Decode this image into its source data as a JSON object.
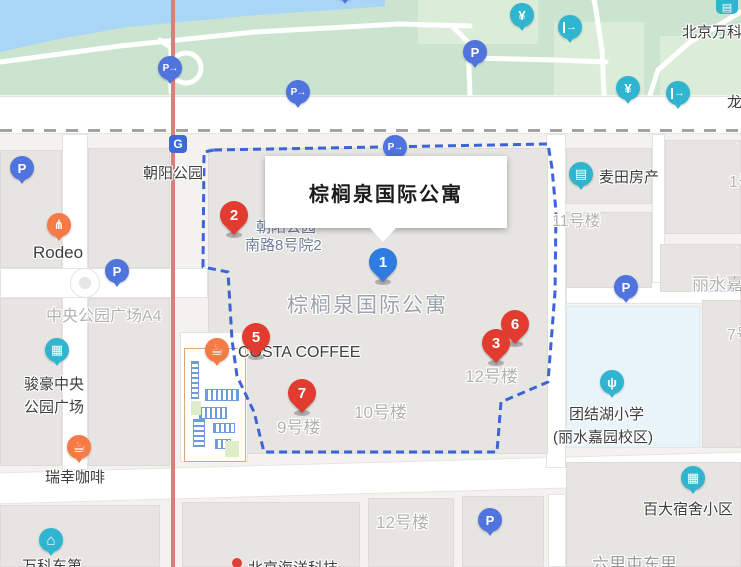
{
  "popup": {
    "title": "棕榈泉国际公寓"
  },
  "colors": {
    "boundary": "#3d63d9",
    "marker_red": "#e23b30",
    "marker_blue": "#2e7ce2",
    "poi_blue": "#4f74dd",
    "poi_teal": "#2fb5cf",
    "poi_orange": "#f57a45",
    "park_green": "#cbe4cf",
    "water": "#a9d6f6",
    "railway": "#d1827b"
  },
  "markers": [
    {
      "n": "2",
      "color": "red",
      "x": 234,
      "y": 215
    },
    {
      "n": "5",
      "color": "red",
      "x": 256,
      "y": 337
    },
    {
      "n": "7",
      "color": "red",
      "x": 302,
      "y": 393
    },
    {
      "n": "6",
      "color": "red",
      "x": 515,
      "y": 324
    },
    {
      "n": "3",
      "color": "red",
      "x": 496,
      "y": 343
    },
    {
      "n": "1",
      "color": "blue",
      "x": 383,
      "y": 262
    }
  ],
  "icon_types": {
    "parking": {
      "g": "P",
      "cls": "blue-poi"
    },
    "parking-arrow": {
      "g": "P→",
      "cls": "blue-poi"
    },
    "ticket": {
      "g": "¥",
      "cls": "teal-poi"
    },
    "exit": {
      "g": "→",
      "cls": "teal-poi"
    },
    "shop": {
      "g": "▤",
      "cls": "teal-poi"
    },
    "building": {
      "g": "▦",
      "cls": "teal-poi"
    },
    "house": {
      "g": "⌂",
      "cls": "teal-poi bigg"
    },
    "sprout": {
      "g": "ψ",
      "cls": "teal-poi"
    },
    "restaurant": {
      "g": "⋔",
      "cls": "orange-poi"
    },
    "coffee": {
      "g": "☕",
      "cls": "orange-poi bigg"
    }
  },
  "pois": [
    {
      "icon": "parking",
      "x": 22,
      "y": 168
    },
    {
      "icon": "parking",
      "x": 117,
      "y": 271
    },
    {
      "icon": "parking",
      "x": 475,
      "y": 52
    },
    {
      "icon": "parking",
      "x": 626,
      "y": 287
    },
    {
      "icon": "parking",
      "x": 490,
      "y": 520
    },
    {
      "icon": "parking",
      "x": 345,
      "y": -12
    },
    {
      "icon": "parking-arrow",
      "x": 170,
      "y": 68
    },
    {
      "icon": "parking-arrow",
      "x": 298,
      "y": 92
    },
    {
      "icon": "parking-arrow",
      "x": 395,
      "y": 147
    },
    {
      "icon": "ticket",
      "x": 522,
      "y": 15
    },
    {
      "icon": "ticket",
      "x": 628,
      "y": 88
    },
    {
      "icon": "exit",
      "x": 570,
      "y": 27
    },
    {
      "icon": "exit",
      "x": 678,
      "y": 93
    },
    {
      "icon": "shop",
      "x": 581,
      "y": 174
    },
    {
      "icon": "building",
      "x": 57,
      "y": 350
    },
    {
      "icon": "building",
      "x": 693,
      "y": 478
    },
    {
      "icon": "house",
      "x": 51,
      "y": 540
    },
    {
      "icon": "sprout",
      "x": 612,
      "y": 382
    },
    {
      "icon": "restaurant",
      "x": 59,
      "y": 225
    },
    {
      "icon": "coffee",
      "x": 217,
      "y": 350
    },
    {
      "icon": "coffee",
      "x": 79,
      "y": 447
    }
  ],
  "metro_glyph": "G",
  "labels": [
    {
      "t": "朝阳公园",
      "x": 143,
      "y": 162,
      "cls": "dk"
    },
    {
      "t": "Rodeo",
      "x": 33,
      "y": 243,
      "cls": "dk17"
    },
    {
      "t": "COSTA COFFEE",
      "x": 238,
      "y": 344,
      "cls": "dk16"
    },
    {
      "t": "麦田房产",
      "x": 599,
      "y": 166,
      "cls": "dk"
    },
    {
      "t": "团结湖小学",
      "x": 569,
      "y": 403,
      "cls": "dk"
    },
    {
      "t": "(丽水嘉园校区)",
      "x": 553,
      "y": 426,
      "cls": "dk"
    },
    {
      "t": "百大宿舍小区",
      "x": 643,
      "y": 498,
      "cls": "dk"
    },
    {
      "t": "北京万科",
      "x": 682,
      "y": 21,
      "cls": "dk"
    },
    {
      "t": "龙",
      "x": 727,
      "y": 91,
      "cls": "dk"
    },
    {
      "t": "骏豪中央",
      "x": 24,
      "y": 373,
      "cls": "dk"
    },
    {
      "t": "公园广场",
      "x": 24,
      "y": 396,
      "cls": "dk"
    },
    {
      "t": "瑞幸咖啡",
      "x": 45,
      "y": 466,
      "cls": "dk"
    },
    {
      "t": "万科东第",
      "x": 22,
      "y": 555,
      "cls": "dk"
    },
    {
      "t": "北京海洋科技",
      "x": 248,
      "y": 557,
      "cls": "dk"
    },
    {
      "t": "六里屯东里",
      "x": 592,
      "y": 550,
      "cls": "faded"
    },
    {
      "t": "朝阳公园",
      "x": 256,
      "y": 216,
      "cls": "bl"
    },
    {
      "t": "南路8号院2",
      "x": 245,
      "y": 234,
      "cls": "bl"
    },
    {
      "t": "中央公园广场A4",
      "x": 46,
      "y": 302,
      "cls": "gr"
    },
    {
      "t": "11号楼",
      "x": 552,
      "y": 207,
      "cls": "gr"
    },
    {
      "t": "1号楼",
      "x": 729,
      "y": 168,
      "cls": "gr"
    },
    {
      "t": "丽水嘉园",
      "x": 692,
      "y": 270,
      "cls": "gr17"
    },
    {
      "t": "7号楼",
      "x": 727,
      "y": 321,
      "cls": "gr"
    },
    {
      "t": "9号楼",
      "x": 277,
      "y": 413,
      "cls": "gr17"
    },
    {
      "t": "10号楼",
      "x": 354,
      "y": 398,
      "cls": "gr17"
    },
    {
      "t": "12号楼",
      "x": 465,
      "y": 362,
      "cls": "gr17"
    },
    {
      "t": "12号楼",
      "x": 376,
      "y": 508,
      "cls": "gr17"
    },
    {
      "t": "棕榈泉国际公寓",
      "x": 287,
      "y": 289,
      "cls": "big"
    }
  ]
}
